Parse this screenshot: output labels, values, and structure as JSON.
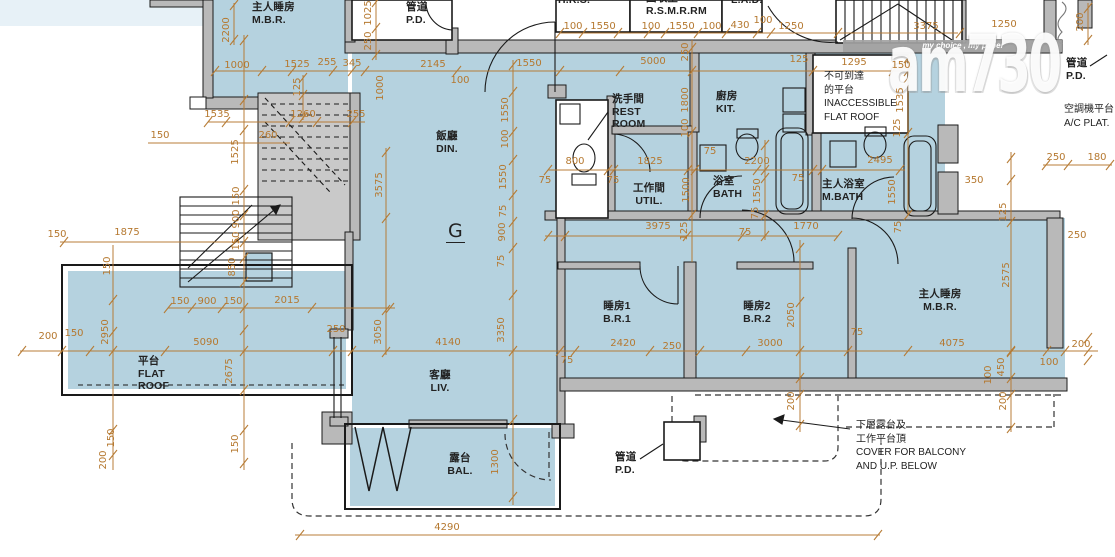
{
  "unit_label": "G",
  "colors": {
    "floor": "#b5d2df",
    "dimension": "#b5782f",
    "wall_gray": "#b9b9b9"
  },
  "watermark": {
    "tagline": "my choice , my paper",
    "logo": "am730"
  },
  "rooms": [
    {
      "id": "room-mbr-adjacent",
      "lines": [
        "主人睡房",
        "M.B.R."
      ],
      "x": 252,
      "y": 1
    },
    {
      "id": "room-pd-top",
      "lines": [
        "管道",
        "P.D."
      ],
      "x": 406,
      "y": 1
    },
    {
      "id": "room-hrs",
      "lines": [
        "H.R.S."
      ],
      "x": 558,
      "y": -6
    },
    {
      "id": "room-rsmrrm",
      "lines": [
        "回收室",
        "R.S.M.R.RM"
      ],
      "x": 646,
      "y": -8
    },
    {
      "id": "room-lad",
      "lines": [
        "L.A.D."
      ],
      "x": 731,
      "y": -6
    },
    {
      "id": "room-dining",
      "lines": [
        "飯廳",
        "DIN."
      ],
      "x": 447,
      "y": 130,
      "align": "c"
    },
    {
      "id": "room-rest-room",
      "lines": [
        "洗手間",
        "REST",
        "ROOM"
      ],
      "x": 612,
      "y": 93
    },
    {
      "id": "room-utility",
      "lines": [
        "工作間",
        "UTIL."
      ],
      "x": 649,
      "y": 182,
      "align": "c"
    },
    {
      "id": "room-kitchen",
      "lines": [
        "廚房",
        "KIT."
      ],
      "x": 716,
      "y": 90
    },
    {
      "id": "room-bath",
      "lines": [
        "浴室",
        "BATH"
      ],
      "x": 713,
      "y": 175
    },
    {
      "id": "room-master-bath",
      "lines": [
        "主人浴室",
        "M.BATH"
      ],
      "x": 822,
      "y": 178
    },
    {
      "id": "room-bedroom1",
      "lines": [
        "睡房1",
        "B.R.1"
      ],
      "x": 617,
      "y": 300,
      "align": "c"
    },
    {
      "id": "room-bedroom2",
      "lines": [
        "睡房2",
        "B.R.2"
      ],
      "x": 757,
      "y": 300,
      "align": "c"
    },
    {
      "id": "room-master-bedroom",
      "lines": [
        "主人睡房",
        "M.B.R."
      ],
      "x": 940,
      "y": 288,
      "align": "c"
    },
    {
      "id": "room-living",
      "lines": [
        "客廳",
        "LIV."
      ],
      "x": 440,
      "y": 369,
      "align": "c"
    },
    {
      "id": "room-balcony",
      "lines": [
        "露台",
        "BAL."
      ],
      "x": 460,
      "y": 452,
      "align": "c"
    },
    {
      "id": "room-flat-roof",
      "lines": [
        "平台",
        "FLAT",
        "ROOF"
      ],
      "x": 138,
      "y": 355
    },
    {
      "id": "room-pd-bottom",
      "lines": [
        "管道",
        "P.D."
      ],
      "x": 615,
      "y": 451
    },
    {
      "id": "room-pd-right",
      "lines": [
        "管道",
        "P.D."
      ],
      "x": 1066,
      "y": 57
    }
  ],
  "annotations": [
    {
      "id": "unit-label",
      "cls": "unit",
      "lines": [
        "G"
      ],
      "x": 446,
      "y": 222
    },
    {
      "id": "note-inaccessible",
      "cls": "note",
      "lines": [
        "不可到達",
        "的平台",
        "INACCESSIBLE",
        "FLAT ROOF"
      ],
      "x": 824,
      "y": 70
    },
    {
      "id": "note-ac-platform",
      "cls": "note",
      "lines": [
        "空調機平台",
        "A/C PLAT."
      ],
      "x": 1064,
      "y": 103
    },
    {
      "id": "note-cover",
      "cls": "note",
      "lines": [
        "下層露台及",
        "工作平台頂",
        "COVER FOR BALCONY",
        "AND U.P. BELOW"
      ],
      "x": 856,
      "y": 419
    },
    {
      "id": "watermark-tagline",
      "cls": "tagline",
      "lines": [
        "my choice , my paper"
      ],
      "x": 963,
      "y": 41,
      "align": "c"
    },
    {
      "id": "watermark-logo",
      "cls": "brand",
      "lines": [
        "am730"
      ],
      "x": 888,
      "y": 30
    }
  ],
  "dimensions": [
    {
      "t": "100",
      "x": 573,
      "y": 27
    },
    {
      "t": "1550",
      "x": 603,
      "y": 27
    },
    {
      "t": "100",
      "x": 651,
      "y": 27
    },
    {
      "t": "1550",
      "x": 682,
      "y": 27
    },
    {
      "t": "100",
      "x": 712,
      "y": 27
    },
    {
      "t": "430",
      "x": 740,
      "y": 26
    },
    {
      "t": "100",
      "x": 763,
      "y": 21
    },
    {
      "t": "1250",
      "x": 791,
      "y": 27
    },
    {
      "t": "3375",
      "x": 926,
      "y": 27
    },
    {
      "t": "1250",
      "x": 1004,
      "y": 25
    },
    {
      "t": "1000",
      "x": 237,
      "y": 66
    },
    {
      "t": "1525",
      "x": 297,
      "y": 65
    },
    {
      "t": "255",
      "x": 327,
      "y": 63
    },
    {
      "t": "345",
      "x": 352,
      "y": 64
    },
    {
      "t": "2145",
      "x": 433,
      "y": 65
    },
    {
      "t": "100",
      "x": 460,
      "y": 81
    },
    {
      "t": "1550",
      "x": 529,
      "y": 64
    },
    {
      "t": "5000",
      "x": 653,
      "y": 62
    },
    {
      "t": "125",
      "x": 799,
      "y": 60
    },
    {
      "t": "1295",
      "x": 854,
      "y": 63
    },
    {
      "t": "150",
      "x": 901,
      "y": 66
    },
    {
      "t": "2200",
      "x": 227,
      "y": 30,
      "v": 1
    },
    {
      "t": "1025",
      "x": 369,
      "y": 13,
      "v": 1
    },
    {
      "t": "250",
      "x": 369,
      "y": 41,
      "v": 1
    },
    {
      "t": "1000",
      "x": 381,
      "y": 88,
      "v": 1
    },
    {
      "t": "125",
      "x": 298,
      "y": 87,
      "v": 1
    },
    {
      "t": "250",
      "x": 686,
      "y": 52,
      "v": 1
    },
    {
      "t": "1800",
      "x": 686,
      "y": 100,
      "v": 1
    },
    {
      "t": "100",
      "x": 686,
      "y": 128,
      "v": 1
    },
    {
      "t": "1535",
      "x": 901,
      "y": 100,
      "v": 1
    },
    {
      "t": "125",
      "x": 898,
      "y": 128,
      "v": 1
    },
    {
      "t": "200",
      "x": 1081,
      "y": 22,
      "v": 1
    },
    {
      "t": "1535",
      "x": 217,
      "y": 115
    },
    {
      "t": "1260",
      "x": 303,
      "y": 115
    },
    {
      "t": "255",
      "x": 356,
      "y": 115
    },
    {
      "t": "260",
      "x": 268,
      "y": 136
    },
    {
      "t": "150",
      "x": 160,
      "y": 136
    },
    {
      "t": "1525",
      "x": 236,
      "y": 152,
      "v": 1
    },
    {
      "t": "150",
      "x": 57,
      "y": 235
    },
    {
      "t": "1875",
      "x": 127,
      "y": 233
    },
    {
      "t": "3575",
      "x": 380,
      "y": 185,
      "v": 1
    },
    {
      "t": "150",
      "x": 237,
      "y": 196,
      "v": 1
    },
    {
      "t": "900",
      "x": 237,
      "y": 219,
      "v": 1
    },
    {
      "t": "150",
      "x": 237,
      "y": 241,
      "v": 1
    },
    {
      "t": "850",
      "x": 233,
      "y": 267,
      "v": 1
    },
    {
      "t": "150",
      "x": 108,
      "y": 266,
      "v": 1
    },
    {
      "t": "1550",
      "x": 506,
      "y": 110,
      "v": 1
    },
    {
      "t": "100",
      "x": 506,
      "y": 139,
      "v": 1
    },
    {
      "t": "1550",
      "x": 504,
      "y": 177,
      "v": 1
    },
    {
      "t": "75",
      "x": 504,
      "y": 211,
      "v": 1
    },
    {
      "t": "900",
      "x": 503,
      "y": 232,
      "v": 1
    },
    {
      "t": "75",
      "x": 502,
      "y": 261,
      "v": 1
    },
    {
      "t": "3350",
      "x": 502,
      "y": 330,
      "v": 1
    },
    {
      "t": "1300",
      "x": 496,
      "y": 462,
      "v": 1
    },
    {
      "t": "800",
      "x": 575,
      "y": 162
    },
    {
      "t": "75",
      "x": 545,
      "y": 181
    },
    {
      "t": "75",
      "x": 613,
      "y": 181
    },
    {
      "t": "1825",
      "x": 650,
      "y": 162
    },
    {
      "t": "2200",
      "x": 757,
      "y": 162
    },
    {
      "t": "75",
      "x": 710,
      "y": 152
    },
    {
      "t": "2495",
      "x": 880,
      "y": 161
    },
    {
      "t": "350",
      "x": 974,
      "y": 181
    },
    {
      "t": "1500",
      "x": 687,
      "y": 190,
      "v": 1
    },
    {
      "t": "125",
      "x": 685,
      "y": 231,
      "v": 1
    },
    {
      "t": "1550",
      "x": 758,
      "y": 191,
      "v": 1
    },
    {
      "t": "75",
      "x": 756,
      "y": 213,
      "v": 1
    },
    {
      "t": "1550",
      "x": 893,
      "y": 192,
      "v": 1
    },
    {
      "t": "75",
      "x": 899,
      "y": 227,
      "v": 1
    },
    {
      "t": "3975",
      "x": 658,
      "y": 227
    },
    {
      "t": "1770",
      "x": 806,
      "y": 227
    },
    {
      "t": "75",
      "x": 745,
      "y": 233
    },
    {
      "t": "75",
      "x": 798,
      "y": 179
    },
    {
      "t": "125",
      "x": 1004,
      "y": 212,
      "v": 1
    },
    {
      "t": "250",
      "x": 1056,
      "y": 158
    },
    {
      "t": "180",
      "x": 1097,
      "y": 158
    },
    {
      "t": "250",
      "x": 1077,
      "y": 236
    },
    {
      "t": "200",
      "x": 48,
      "y": 337
    },
    {
      "t": "150",
      "x": 74,
      "y": 334
    },
    {
      "t": "2950",
      "x": 106,
      "y": 332,
      "v": 1
    },
    {
      "t": "5090",
      "x": 206,
      "y": 343
    },
    {
      "t": "2675",
      "x": 230,
      "y": 371,
      "v": 1
    },
    {
      "t": "250",
      "x": 336,
      "y": 330
    },
    {
      "t": "3050",
      "x": 379,
      "y": 332,
      "v": 1
    },
    {
      "t": "4140",
      "x": 448,
      "y": 343
    },
    {
      "t": "75",
      "x": 567,
      "y": 361
    },
    {
      "t": "2420",
      "x": 623,
      "y": 344
    },
    {
      "t": "250",
      "x": 672,
      "y": 347
    },
    {
      "t": "3000",
      "x": 770,
      "y": 344
    },
    {
      "t": "2050",
      "x": 792,
      "y": 315,
      "v": 1
    },
    {
      "t": "75",
      "x": 857,
      "y": 333
    },
    {
      "t": "4075",
      "x": 952,
      "y": 344
    },
    {
      "t": "2575",
      "x": 1007,
      "y": 275,
      "v": 1
    },
    {
      "t": "200",
      "x": 1081,
      "y": 345
    },
    {
      "t": "100",
      "x": 1049,
      "y": 363
    },
    {
      "t": "450",
      "x": 1002,
      "y": 367,
      "v": 1
    },
    {
      "t": "100",
      "x": 989,
      "y": 375,
      "v": 1
    },
    {
      "t": "200",
      "x": 792,
      "y": 401,
      "v": 1
    },
    {
      "t": "200",
      "x": 1004,
      "y": 401,
      "v": 1
    },
    {
      "t": "150",
      "x": 180,
      "y": 302
    },
    {
      "t": "900",
      "x": 207,
      "y": 302
    },
    {
      "t": "150",
      "x": 233,
      "y": 302
    },
    {
      "t": "2015",
      "x": 287,
      "y": 301
    },
    {
      "t": "150",
      "x": 112,
      "y": 438,
      "v": 1
    },
    {
      "t": "200",
      "x": 104,
      "y": 460,
      "v": 1
    },
    {
      "t": "150",
      "x": 236,
      "y": 444,
      "v": 1
    },
    {
      "t": "4290",
      "x": 447,
      "y": 528
    }
  ]
}
